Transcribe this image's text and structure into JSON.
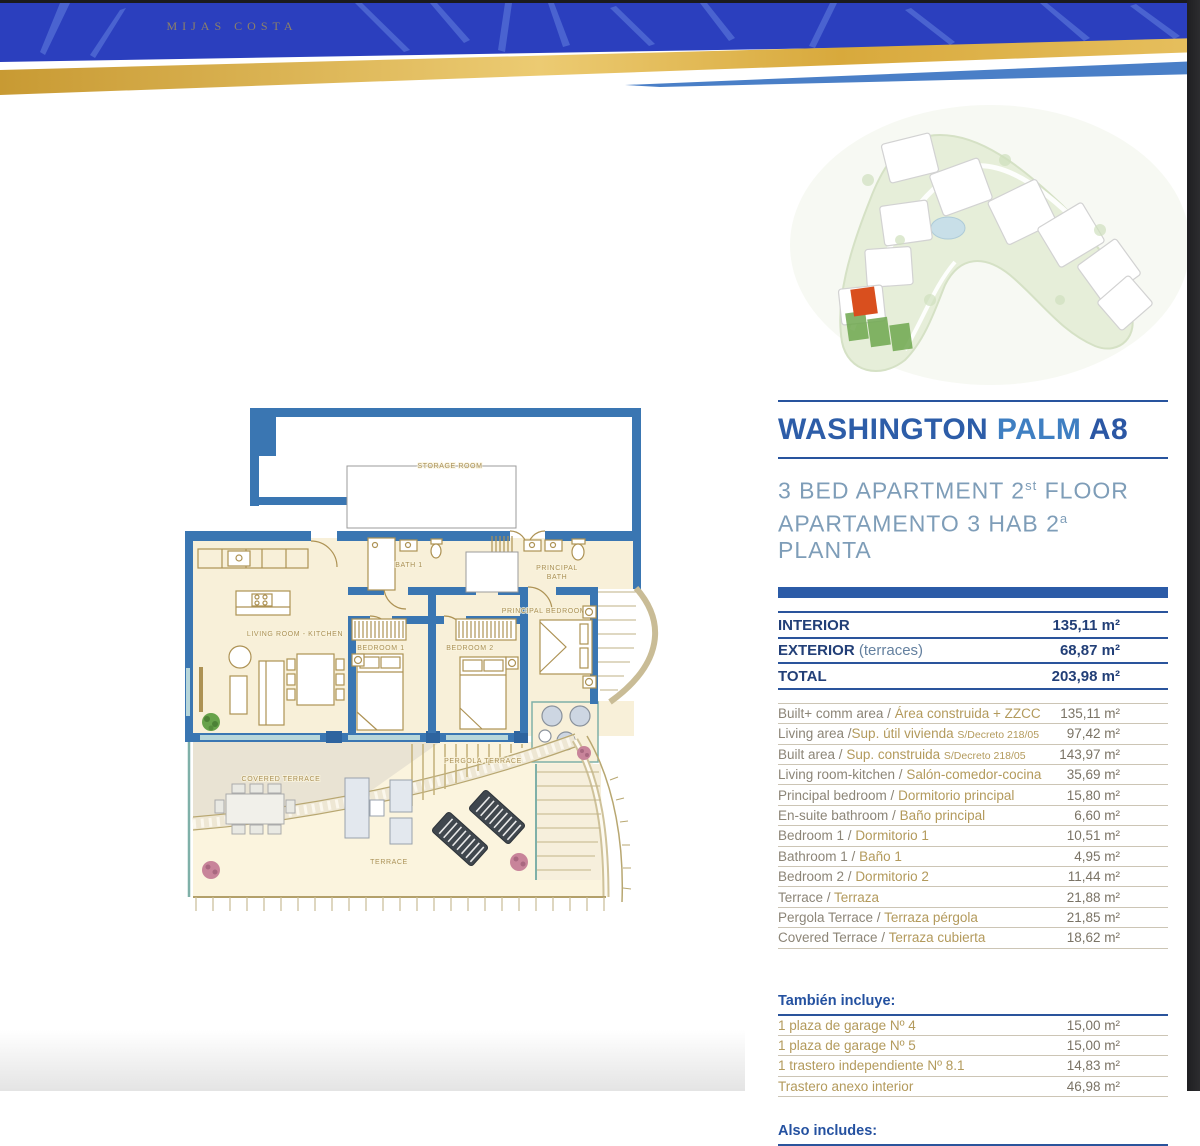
{
  "header": {
    "brand": "MIJAS COSTA"
  },
  "title_block": {
    "parts": [
      "WASHINGTON",
      "PALM",
      "A8"
    ],
    "line1_pre": "3 BED APARTMENT 2",
    "line1_sup": "st",
    "line1_post": " FLOOR",
    "line2_pre": "APARTAMENTO 3 HAB 2",
    "line2_sup": "a",
    "line2_post": " PLANTA"
  },
  "summary": {
    "rows": [
      {
        "label": "INTERIOR",
        "note": "",
        "value": "135,11 m²"
      },
      {
        "label": "EXTERIOR",
        "note": "(terraces)",
        "value": "68,87 m²"
      },
      {
        "label": "TOTAL",
        "note": "",
        "value": "203,98 m²"
      }
    ]
  },
  "areas": {
    "rows": [
      {
        "en": "Built+ comm  area /",
        "es": "Área construida + ZZCC",
        "note": "",
        "value": "135,11 m²"
      },
      {
        "en": "Living area /",
        "es": "Sup. útil vivienda",
        "note": "S/Decreto 218/05",
        "value": "97,42 m²"
      },
      {
        "en": "Built area /",
        "es": "Sup. construida",
        "note": "S/Decreto 218/05",
        "value": "143,97 m²"
      },
      {
        "en": "Living room-kitchen /",
        "es": "Salón-comedor-cocina",
        "note": "",
        "value": "35,69 m²"
      },
      {
        "en": "Principal bedroom /",
        "es": "Dormitorio principal",
        "note": "",
        "value": "15,80 m²"
      },
      {
        "en": "En-suite bathroom /",
        "es": "Baño principal",
        "note": "",
        "value": "6,60 m²"
      },
      {
        "en": "Bedroom 1 /",
        "es": "Dormitorio 1",
        "note": "",
        "value": "10,51 m²"
      },
      {
        "en": "Bathroom 1 /",
        "es": "Baño 1",
        "note": "",
        "value": "4,95 m²"
      },
      {
        "en": "Bedroom 2 /",
        "es": "Dormitorio 2",
        "note": "",
        "value": "11,44 m²"
      },
      {
        "en": "Terrace /",
        "es": "Terraza",
        "note": "",
        "value": "21,88 m²"
      },
      {
        "en": "Pergola Terrace /",
        "es": "Terraza pérgola",
        "note": "",
        "value": "21,85 m²"
      },
      {
        "en": "Covered Terrace /",
        "es": "Terraza cubierta",
        "note": "",
        "value": "18,62 m²"
      }
    ]
  },
  "include": {
    "heading": "También incluye:",
    "rows": [
      {
        "label": "1 plaza de garage Nº 4",
        "value": "15,00 m²"
      },
      {
        "label": "1 plaza de garage Nº 5",
        "value": "15,00 m²"
      },
      {
        "label": "1 trastero independiente Nº 8.1",
        "value": "14,83 m²"
      },
      {
        "label": "Trastero anexo interior",
        "value": "46,98 m²"
      }
    ],
    "heading2": "Also includes:"
  },
  "floorplan": {
    "labels": {
      "storage": "STORAGE ROOM",
      "bath1": "BATH 1",
      "principal_bath_1": "PRINCIPAL",
      "principal_bath_2": "BATH",
      "principal_bedroom": "PRINCIPAL BEDROOM",
      "living": "LIVING ROOM - KITCHEN",
      "bedroom1": "BEDROOM 1",
      "bedroom2": "BEDROOM 2",
      "covered_terrace": "COVERED TERRACE",
      "pergola_terrace": "PERGOLA TERRACE",
      "terrace": "TERRACE"
    }
  },
  "colors": {
    "accent_navy": "#28549e",
    "title_blue": "#2d5da8",
    "title_blue_light": "#3f7fc2",
    "subtitle_blue": "#7e9db8",
    "gold_text": "#b39a5c",
    "gray_text": "#8c8577",
    "wall_blue": "#3a76b2",
    "floor_cream": "#f8f0d9",
    "header_blue": "#2b41bd",
    "header_gold": "#d8a93c",
    "highlight_orange": "#d94f1e"
  }
}
